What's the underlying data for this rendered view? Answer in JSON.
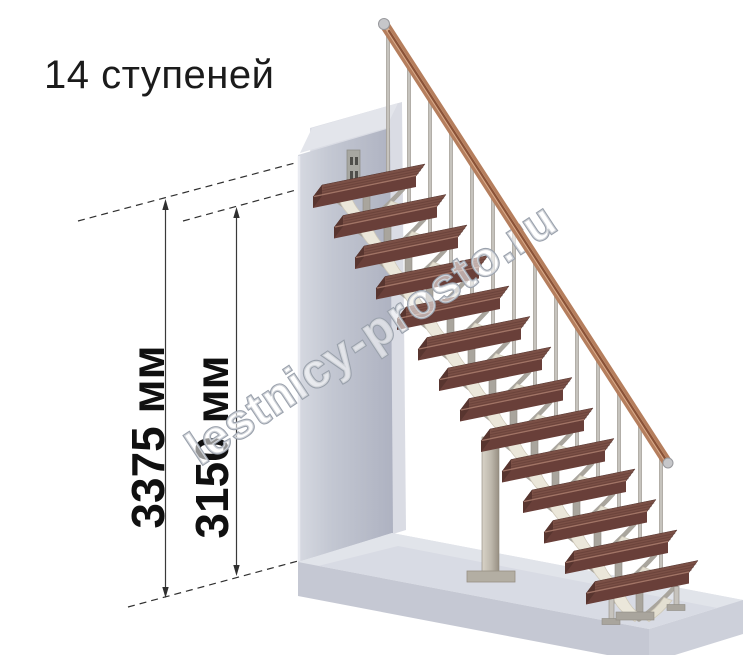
{
  "title": "14 ступеней",
  "watermark": "lestnicy-prosto.ru",
  "dimensions": {
    "overall_height": "3375 мм",
    "stair_height": "3150 мм"
  },
  "stairs": {
    "step_count": 14,
    "unit": "мм"
  },
  "colors": {
    "tread_top": "#7b5046",
    "tread_front": "#693f39",
    "tread_end": "#58352f",
    "tread_grain": "#5c3731",
    "tread_highlight": "#a87a6b",
    "handrail": "#b57e5d",
    "handrail_light": "#d9ac8c",
    "handrail_dark": "#8a5237",
    "metal": "#a9a59d",
    "metal_light": "#c6c3bd",
    "metal_edge": "#8f8b83",
    "cream": "#ebe7da",
    "cream_dark": "#e3dfd1",
    "wall_light": "#d6d9e1",
    "wall_dark": "#aeb2c1",
    "wall_back": "#dadce4",
    "wall_band": "#e3e5eb",
    "floor_top": "#d8dbe4",
    "floor_band": "#e2e4ea",
    "floor_front": "#c5c8d3",
    "floor_side": "#cdd0da",
    "column_light": "#d8d3c8",
    "column_dark": "#978f82",
    "dimension_line": "#3a3a3a",
    "watermark_stroke": "#9aa1ac"
  }
}
